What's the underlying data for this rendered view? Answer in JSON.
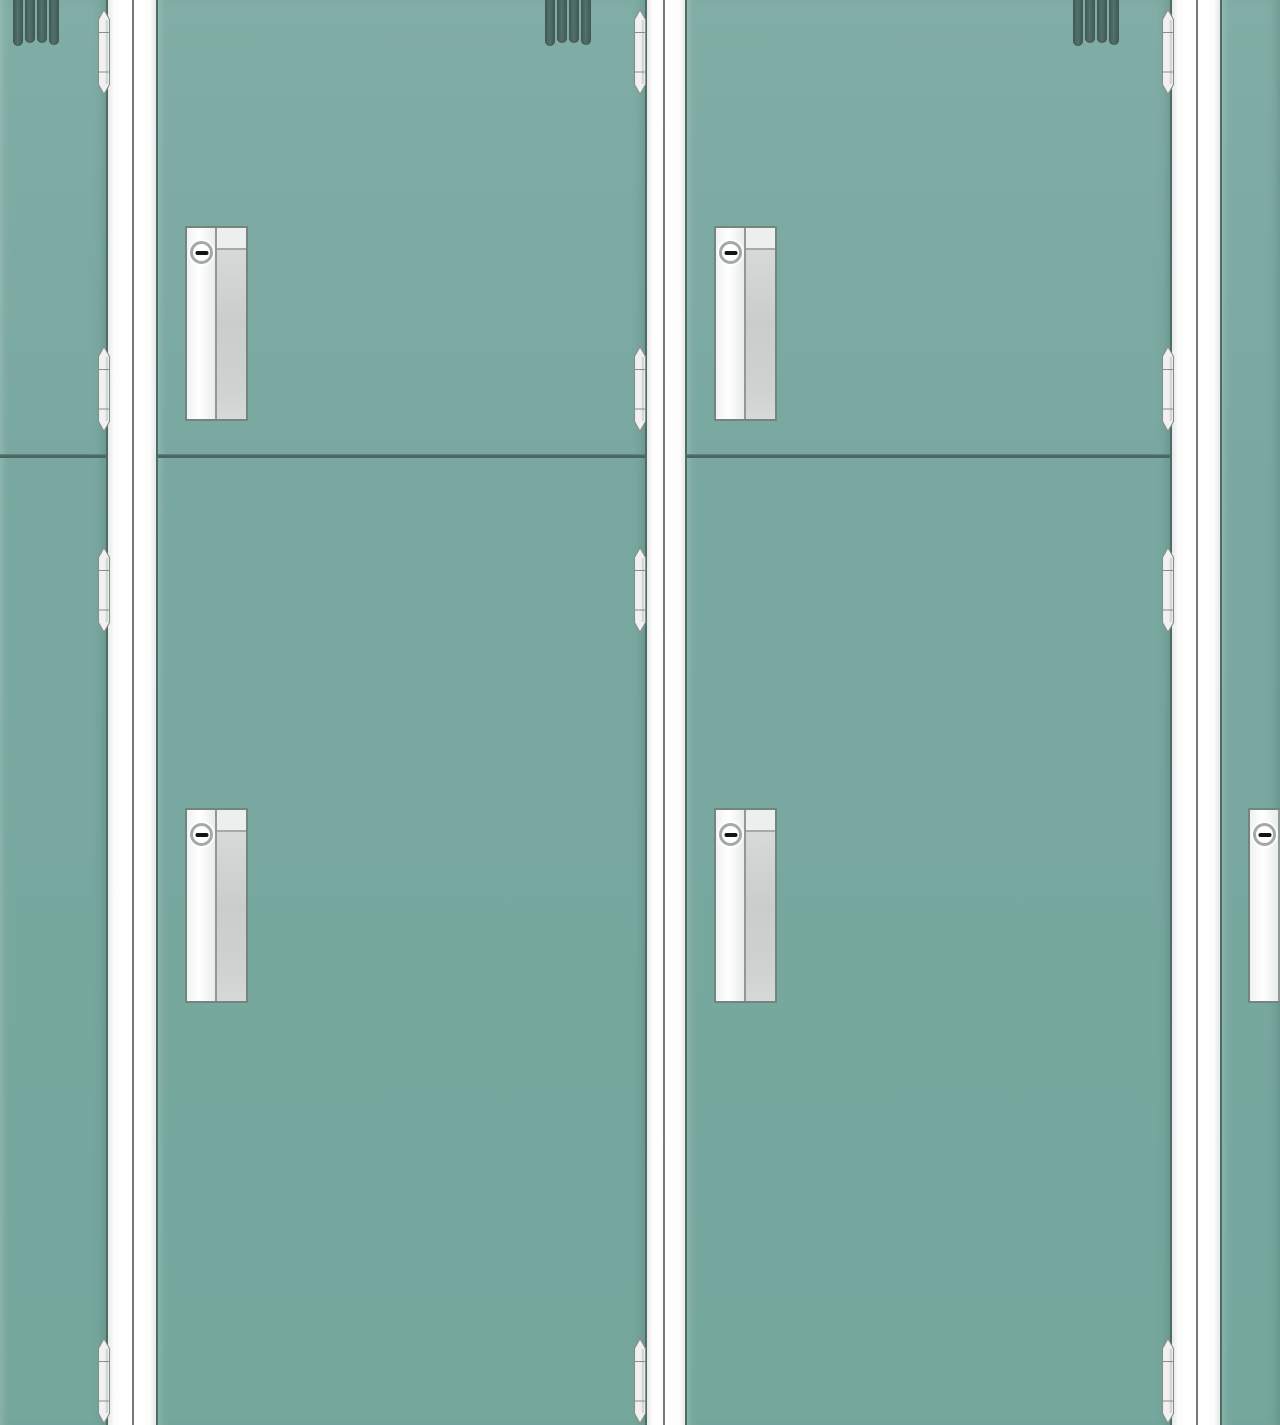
{
  "scene": {
    "type": "illustration",
    "subject": "wall-of-teal-storage-lockers-front-view",
    "canvas": {
      "width": 1280,
      "height": 1425
    },
    "colors": {
      "door_face": "#79a8a0",
      "door_face_light": "#80ada5",
      "door_face_dark": "#75a79d",
      "door_edge": "#4f6b66",
      "divider_line": "#4a6662",
      "divider_highlight": "#678c85",
      "frame_white": "#fdfdfd",
      "frame_shade": "#e7eae9",
      "frame_line": "#757a78",
      "vent_fill": "#53706a",
      "vent_edge": "#3e5854",
      "hinge_fill": "#f0f1f0",
      "hinge_edge": "#878f8b",
      "handle_border": "#74847f",
      "handle_left_shade": "#e9ecea",
      "handle_grip_top": "#edefee",
      "handle_grip_fill": "#c9cdcb",
      "lock_ring": "#a2aaa7",
      "lock_slot": "#141414"
    },
    "frame_strips": [
      {
        "x": 106,
        "width": 52,
        "line_x": 132
      },
      {
        "x": 645,
        "width": 42,
        "line_x": 663
      },
      {
        "x": 1170,
        "width": 52,
        "line_x": 1196
      }
    ],
    "lockers": [
      {
        "id": "left-partial",
        "x": 0,
        "width": 106,
        "split_y": 454,
        "vents_x": 13,
        "hinges_x": 97,
        "hinges_y": [
          9,
          346,
          547,
          1338
        ],
        "handles": []
      },
      {
        "id": "1",
        "x": 158,
        "width": 487,
        "split_y": 454,
        "vents_x": 545,
        "hinges_x": 633,
        "hinges_y": [
          9,
          346,
          547,
          1338
        ],
        "handles": [
          {
            "x": 185,
            "y": 226
          },
          {
            "x": 185,
            "y": 808
          }
        ]
      },
      {
        "id": "2",
        "x": 687,
        "width": 483,
        "split_y": 454,
        "vents_x": 1073,
        "hinges_x": 1161,
        "hinges_y": [
          9,
          346,
          547,
          1338
        ],
        "handles": [
          {
            "x": 714,
            "y": 226
          },
          {
            "x": 714,
            "y": 808
          }
        ]
      },
      {
        "id": "right-partial",
        "x": 1222,
        "width": 58,
        "split_y": null,
        "vents_x": null,
        "hinges_x": null,
        "hinges_y": [],
        "handles": [
          {
            "x": 1248,
            "y": 808
          }
        ]
      }
    ],
    "vent": {
      "bar_width": 9.5,
      "offsets": [
        0,
        12,
        24,
        36
      ],
      "heights": [
        46,
        43,
        43,
        45
      ]
    },
    "hinge": {
      "width": 14,
      "height": 86
    },
    "handle": {
      "width": 63,
      "height": 195,
      "left_width": 28,
      "band_height": 22
    }
  }
}
